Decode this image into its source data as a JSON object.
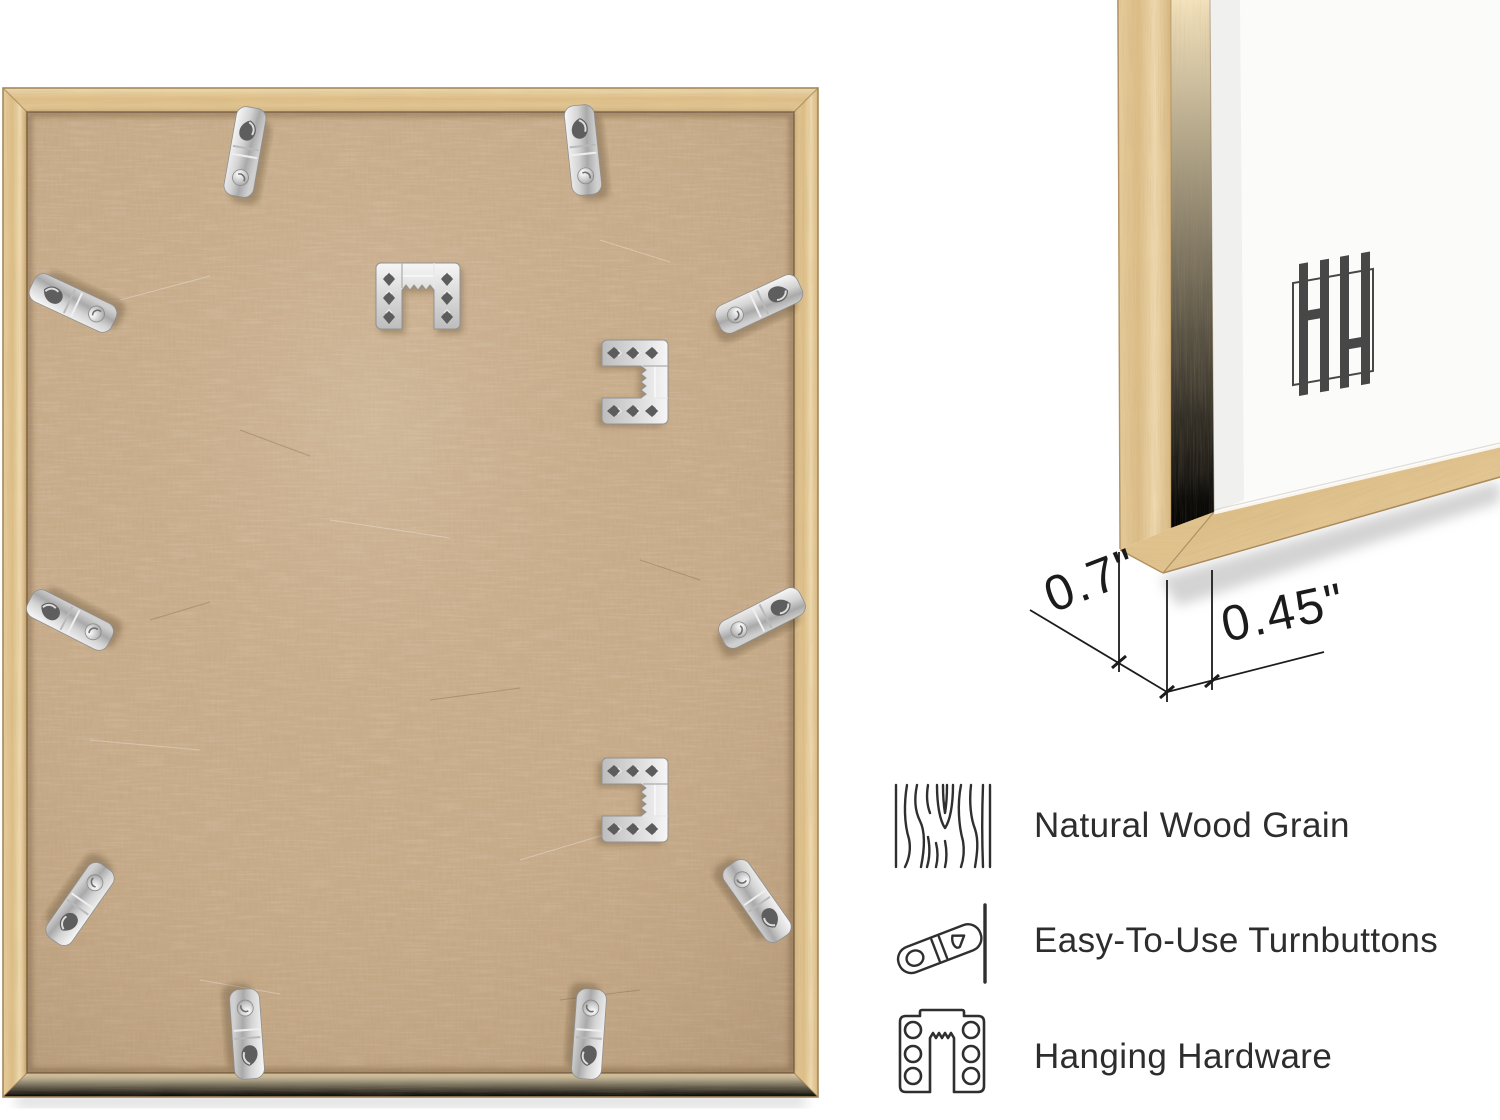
{
  "annotations": {
    "depth": "0.7\"",
    "face_width": "0.45\""
  },
  "features": [
    {
      "icon": "wood-grain-icon",
      "label": "Natural Wood Grain"
    },
    {
      "icon": "turnbutton-icon",
      "label": "Easy-To-Use Turnbuttons"
    },
    {
      "icon": "hanging-hardware-icon",
      "label": "Hanging Hardware"
    }
  ],
  "logo": {
    "icon": "hh-monogram-logo",
    "color": "#474747"
  },
  "hardware_counts": {
    "turnbuttons": 10,
    "sawtooth_hangers": 3
  },
  "colors": {
    "wood": "#e9d1a3",
    "backboard": "#c9ae8d",
    "metal": "#d9d9d9",
    "mat": "#fbfbfa",
    "annotation_line": "#1b1b1b",
    "feature_text": "#2d2d2d"
  }
}
